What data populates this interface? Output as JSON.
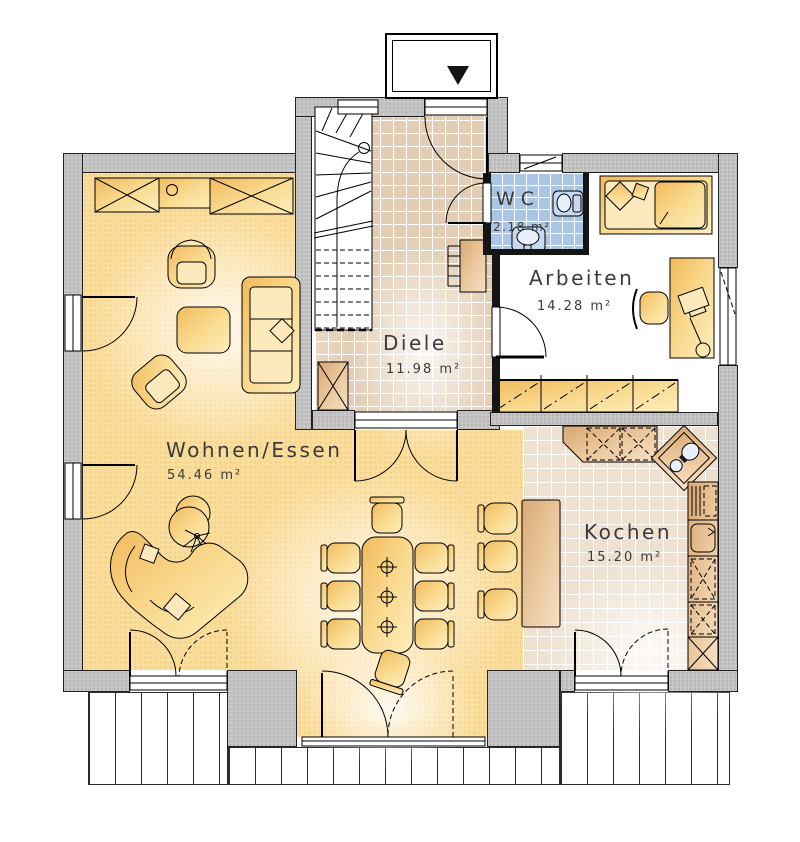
{
  "rooms": [
    {
      "name": "Wohnen/Essen",
      "area": "54.46 m²"
    },
    {
      "name": "Diele",
      "area": "11.98 m²"
    },
    {
      "name": "WC",
      "area": "2.18 m²"
    },
    {
      "name": "Arbeiten",
      "area": "14.28 m²"
    },
    {
      "name": "Kochen",
      "area": "15.20 m²"
    }
  ],
  "colors": {
    "wall_fill": "#c6c6c6",
    "living_floor": "#fbdd9b",
    "hall_tile": "#e3ceb5",
    "wc_tile": "#abc5e5",
    "kitchen_tile": "#eee1d2",
    "furniture_accent": "#f6c568",
    "counter_accent": "#dfae7e"
  }
}
